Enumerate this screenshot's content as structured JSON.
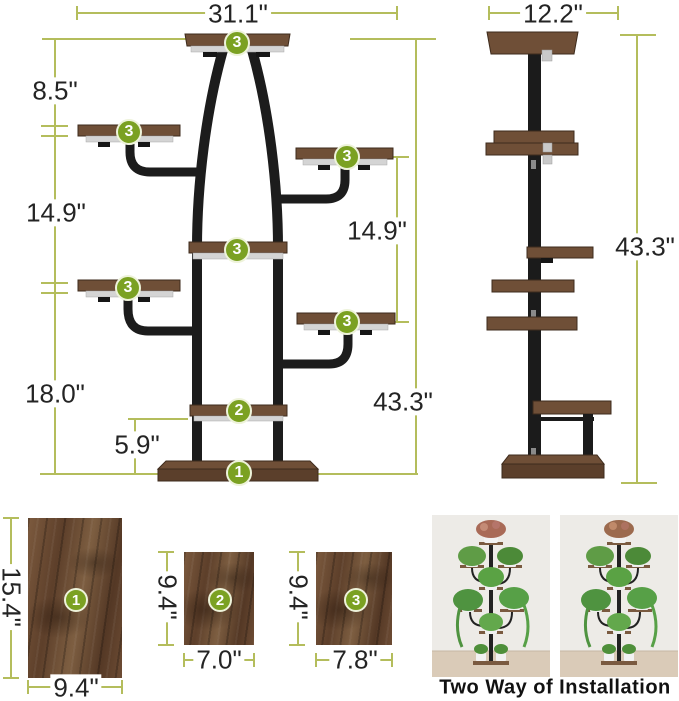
{
  "colors": {
    "dimension_line": "#b4bd5c",
    "badge_green": "#7ba122",
    "wood_brown": "#6f4f37",
    "metal_black": "#1c1c1c",
    "photo_wall": "#edebe7",
    "photo_floor": "#dacbb8"
  },
  "front_view": {
    "width_label": "31.1\"",
    "height_label": "43.3\"",
    "gap_top": "8.5\"",
    "gap_left_mid": "14.9\"",
    "gap_left_bottom": "18.0\"",
    "gap_right": "14.9\"",
    "shelf2_height": "5.9\"",
    "badges": {
      "top_shelf": "3",
      "upper_left_shelf": "3",
      "upper_right_shelf": "3",
      "middle_shelf": "3",
      "lower_left_shelf": "3",
      "lower_right_shelf": "3",
      "second_shelf": "2",
      "base_shelf": "1"
    }
  },
  "side_view": {
    "width_label": "12.2\"",
    "height_label": "43.3\""
  },
  "panels": [
    {
      "badge": "1",
      "height_label": "15.4\"",
      "width_label": "9.4\""
    },
    {
      "badge": "2",
      "height_label": "9.4\"",
      "width_label": "7.0\""
    },
    {
      "badge": "3",
      "badge_note": "",
      "height_label": "9.4\"",
      "width_label": "7.8\""
    }
  ],
  "installation": {
    "caption": "Two Way of Installation"
  }
}
